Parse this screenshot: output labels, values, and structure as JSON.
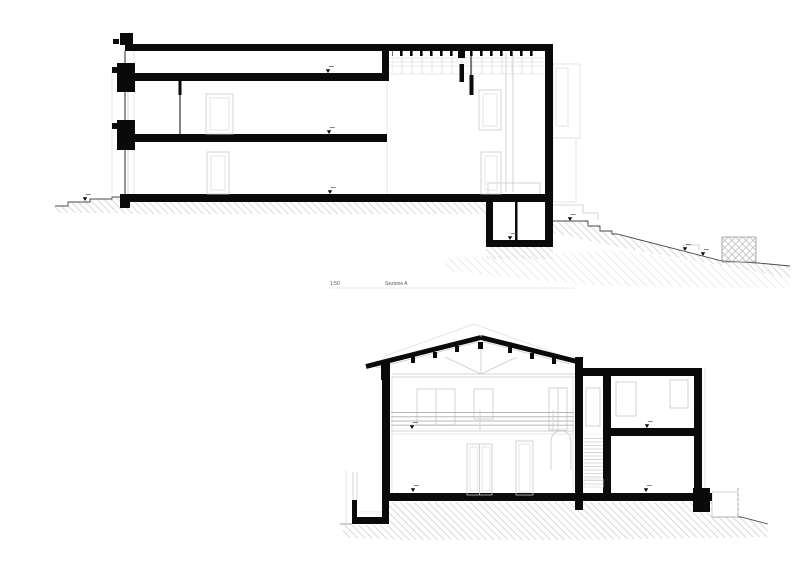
{
  "document": {
    "type": "architectural section drawing",
    "background": "#ffffff"
  },
  "title_block": {
    "scale_label": "1:50",
    "drawing_label": "Sezione A"
  },
  "colors": {
    "ink": "#0a0a0a",
    "mid_line": "#666666",
    "light_line": "#c9c9c9",
    "faint_line": "#e0e0e0",
    "terrain_line": "#4a4a4a",
    "crosshatch_line": "#b5b5b5"
  },
  "symbols": {
    "level_marker": "filled-down-triangle"
  },
  "drawings": [
    {
      "id": "upper-section",
      "description": "Building section with flat roofs, basement room and stepped sloping terrain"
    },
    {
      "id": "lower-section",
      "description": "Building cross section with gable roof, balcony railing and stair annex"
    }
  ]
}
